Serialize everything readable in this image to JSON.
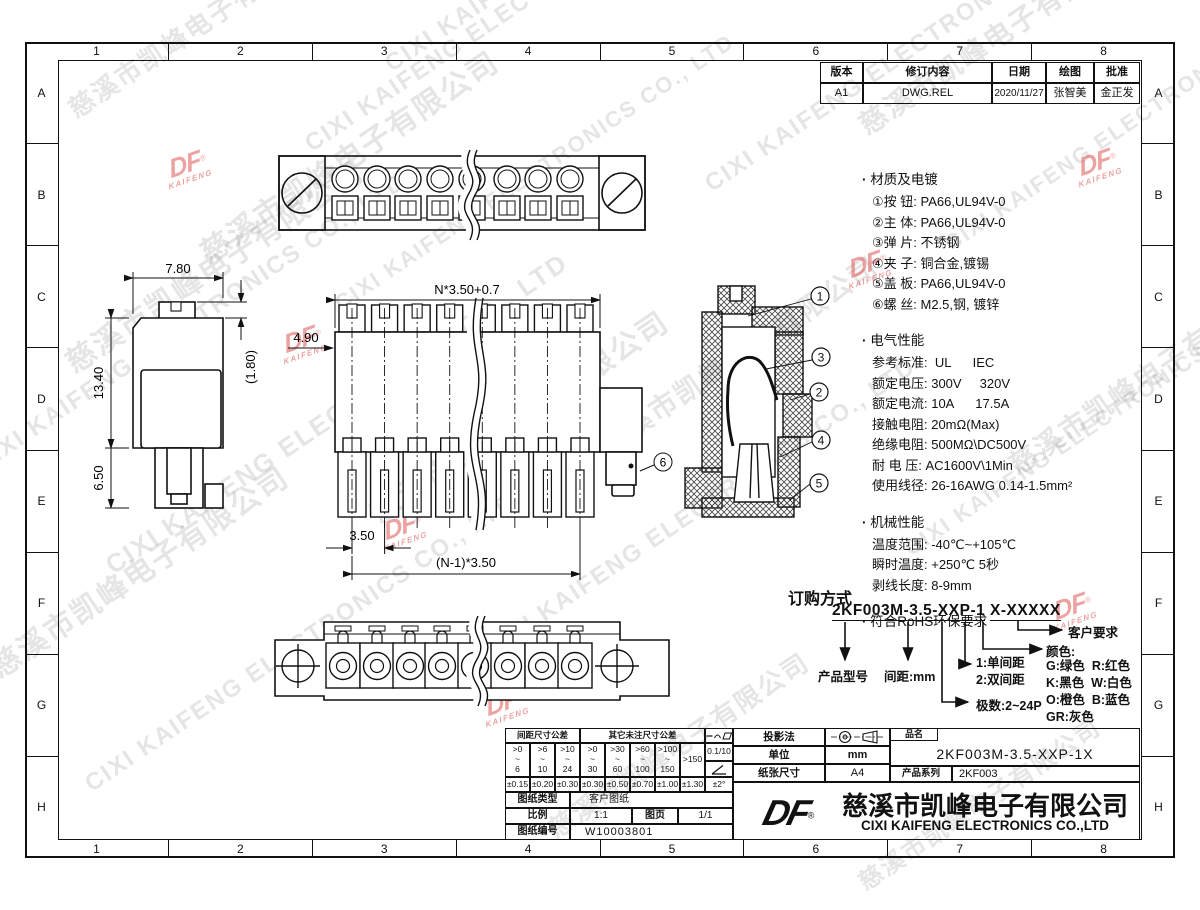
{
  "watermark": {
    "company_cn": "慈溪市凯峰电子有限公司",
    "company_en": "CIXI KAIFENG ELECTRONICS CO., LTD",
    "logo_text": "DF",
    "logo_sub": "KAIFENG",
    "registered": "®"
  },
  "frame": {
    "cols": [
      "1",
      "2",
      "3",
      "4",
      "5",
      "6",
      "7",
      "8"
    ],
    "rows": [
      "A",
      "B",
      "C",
      "D",
      "E",
      "F",
      "G",
      "H"
    ]
  },
  "revision": {
    "headers": [
      "版本",
      "修订内容",
      "日期",
      "绘图",
      "批准"
    ],
    "row": [
      "A1",
      "DWG.REL",
      "2020/11/27",
      "张智美",
      "金正发"
    ]
  },
  "dims": {
    "side_width": "7.80",
    "side_height": "13.40",
    "side_pin": "6.50",
    "side_tab": "(1.80)",
    "front_total": "N*3.50+0.7",
    "front_top": "4.90",
    "front_pitch": "3.50",
    "front_span": "(N-1)*3.50"
  },
  "callouts": {
    "c1": "1",
    "c2": "2",
    "c3": "3",
    "c4": "4",
    "c5": "5",
    "c6": "6"
  },
  "specs": {
    "material": {
      "title": "材质及电镀",
      "items": [
        "①按 钮: PA66,UL94V-0",
        "②主 体: PA66,UL94V-0",
        "③弹 片: 不锈钢",
        "④夹 子: 铜合金,镀锡",
        "⑤盖 板: PA66,UL94V-0",
        "⑥螺 丝: M2.5,钢, 镀锌"
      ]
    },
    "electrical": {
      "title": "电气性能",
      "items": [
        "参考标准:  UL      IEC",
        "额定电压: 300V     320V",
        "额定电流: 10A      17.5A",
        "接触电阻: 20mΩ(Max)",
        "绝缘电阻: 500MΩ\\DC500V",
        "耐 电 压: AC1600V\\1Min",
        "使用线径: 26-16AWG 0.14-1.5mm²"
      ]
    },
    "mechanical": {
      "title": "机械性能",
      "items": [
        "温度范围: -40℃~+105℃",
        "瞬时温度: +250℃ 5秒",
        "剥线长度: 8-9mm"
      ]
    },
    "rohs": "符合RoHS环保要求"
  },
  "ordering": {
    "title": "订购方式",
    "pn_left": "2KF003M-3.5-XXP-1",
    "pn_right": "X-XXXXX",
    "product_label": "产品型号",
    "pitch_label": "间距:mm",
    "poles_label": "极数:2~24P",
    "spacing_options": [
      "1:单间距",
      "2:双间距"
    ],
    "color_title": "颜色:",
    "color_options": [
      "G:绿色  R:红色",
      "K:黑色  W:白色",
      "O:橙色  B:蓝色",
      "GR:灰色"
    ],
    "customer_label": "客户要求"
  },
  "title_block": {
    "tol": {
      "pitch_header": "间距尺寸公差",
      "other_header": "其它未注尺寸公差",
      "pitch_ranges": [
        ">0\n~\n6",
        ">6\n~\n10",
        ">10\n~\n24"
      ],
      "other_ranges": [
        ">0\n~\n30",
        ">30\n~\n60",
        ">60\n~\n100",
        ">100\n~\n150"
      ],
      "over_range": ">150",
      "pitch_tols": [
        "±0.15",
        "±0.20",
        "±0.30"
      ],
      "other_tols": [
        "±0.30",
        "±0.50",
        "±0.70",
        "±1.00",
        "±1.30"
      ],
      "angle_tol": "±2°",
      "flatness": "0.1/10"
    },
    "projection_label": "投影法",
    "unit_label": "单位",
    "unit_value": "mm",
    "paper_label": "纸张尺寸",
    "paper_value": "A4",
    "type_label": "图纸类型",
    "type_value": "客户图纸",
    "scale_label": "比例",
    "scale_value": "1:1",
    "page_label": "图页",
    "page_value": "1/1",
    "docno_label": "图纸编号",
    "docno_value": "W10003801",
    "name_label": "品名",
    "name_value": "2KF003M-3.5-XXP-1X",
    "series_label": "产品系列",
    "series_value": "2KF003",
    "company_cn": "慈溪市凯峰电子有限公司",
    "company_en": "CIXI KAIFENG ELECTRONICS CO.,LTD"
  }
}
